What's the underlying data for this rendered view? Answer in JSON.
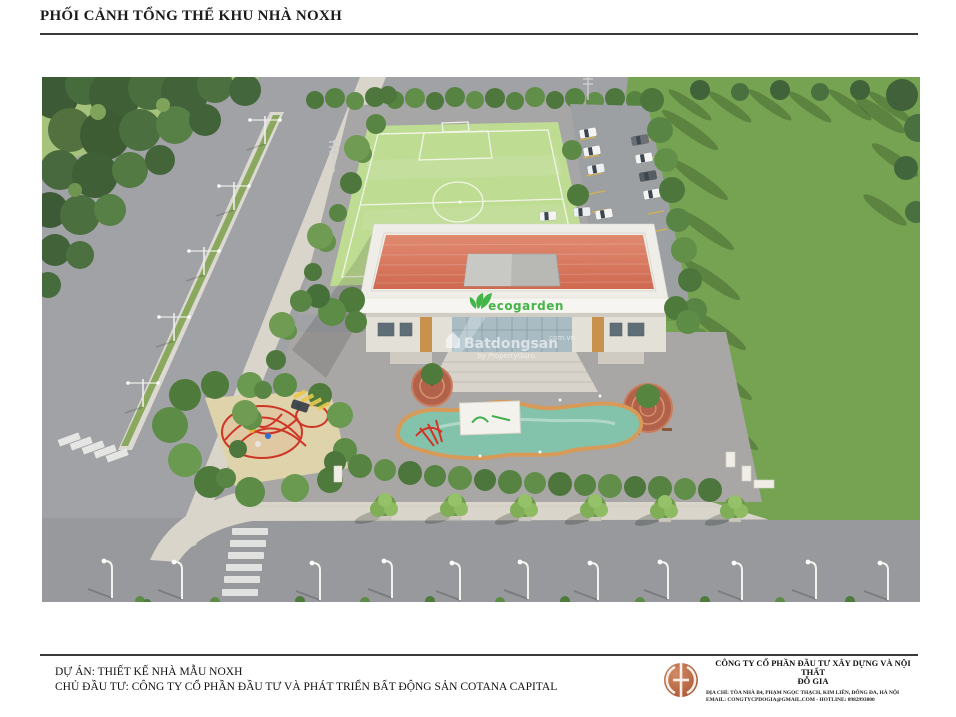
{
  "page": {
    "title": "PHỐI CẢNH TỔNG THỂ KHU NHÀ NOXH"
  },
  "rendering": {
    "building_sign": "ecogarden",
    "watermark": {
      "brand": "Batdongsan",
      "domain": ".com.vn",
      "tagline": "by PropertyGuru"
    }
  },
  "footer": {
    "project": "DỰ ÁN: THIẾT KẾ NHÀ MẪU NOXH",
    "investor": "CHỦ ĐẦU TƯ: CÔNG TY CỔ PHẦN ĐẦU TƯ VÀ PHÁT TRIỂN BẤT ĐỘNG SẢN COTANA CAPITAL",
    "company": {
      "name_line1": "CÔNG TY CỔ PHẦN ĐẦU TƯ XÂY DỰNG VÀ NỘI THẤT",
      "name_line2": "ĐỖ GIA",
      "address": "ĐỊA CHỈ: TÒA NHÀ B4, PHẠM NGỌC THẠCH, KIM LIÊN, ĐỐNG ĐA, HÀ NỘI",
      "contact": "EMAIL: CONGTYCPDOGIA@GMAIL.COM - HOTLINE: 0982993800"
    }
  },
  "colors": {
    "ecogarden_green": "#44b549",
    "roof_terracotta": "#d9785f",
    "logo_terracotta": "#b4603c"
  }
}
